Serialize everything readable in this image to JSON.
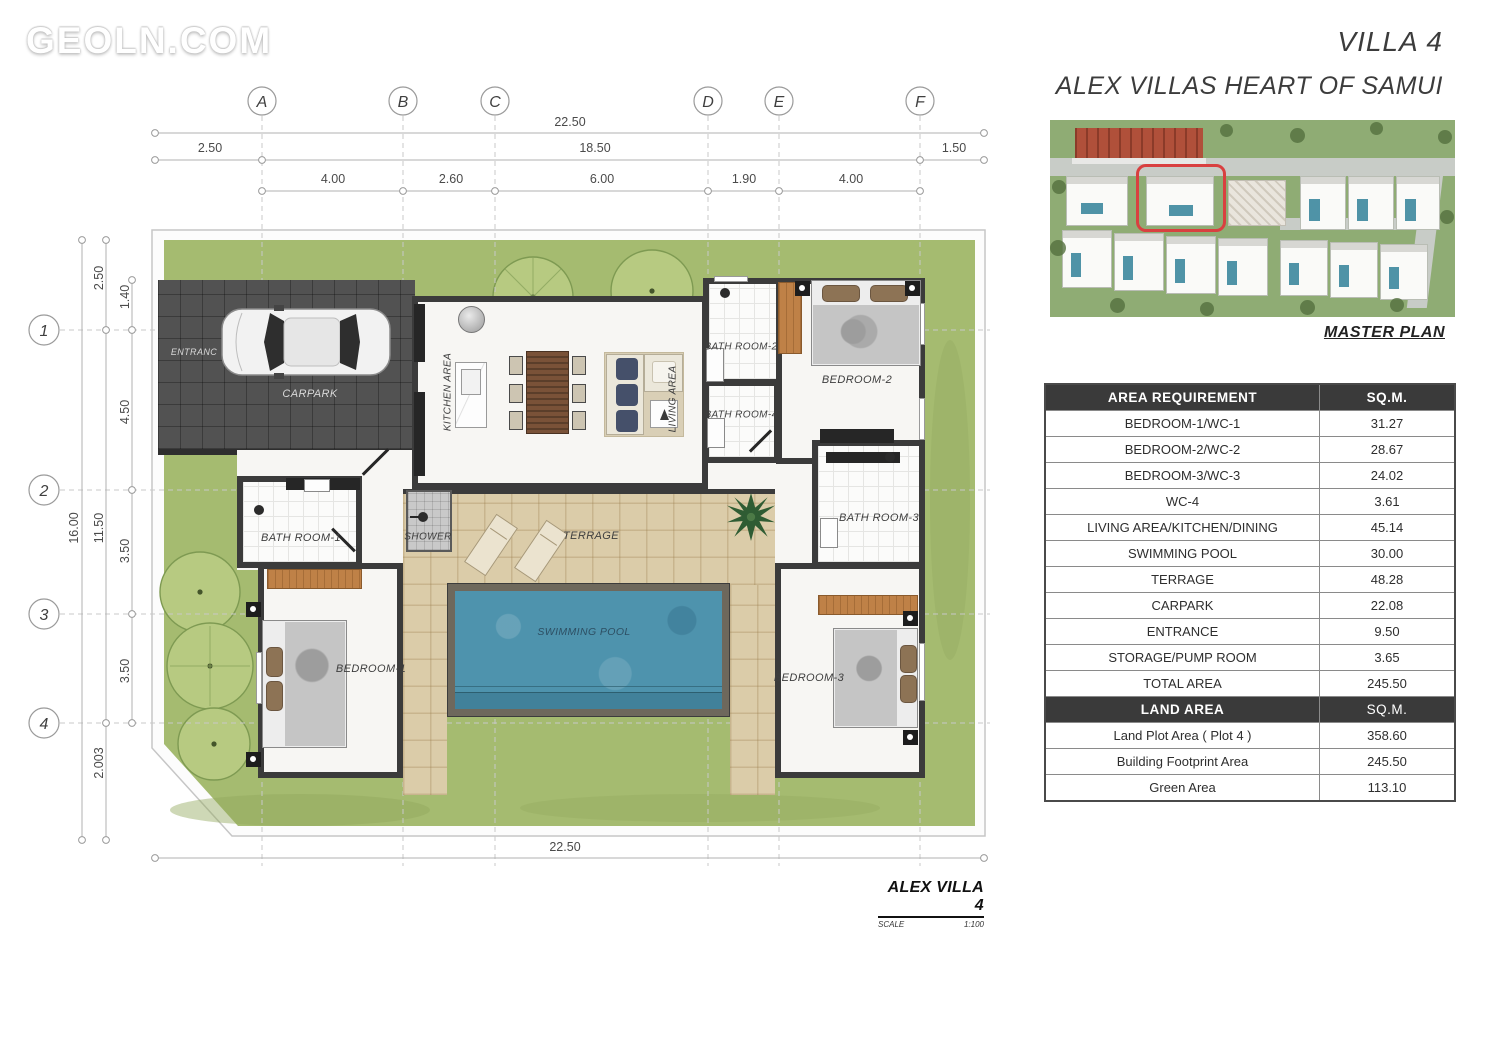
{
  "watermark": "GEOLN.COM",
  "header": {
    "villa": "VILLA 4",
    "project": "ALEX VILLAS HEART OF SAMUI",
    "master_plan": "MASTER PLAN"
  },
  "titleblock": {
    "title": "ALEX VILLA 4",
    "scale_label": "SCALE",
    "scale_value": "1:100"
  },
  "grid": {
    "cols": [
      "A",
      "B",
      "C",
      "D",
      "E",
      "F"
    ],
    "rows": [
      "1",
      "2",
      "3",
      "4"
    ]
  },
  "dims": {
    "top_total": "22.50",
    "top_left": "2.50",
    "top_mid": "18.50",
    "top_right": "1.50",
    "ab": "4.00",
    "bc": "2.60",
    "cd": "6.00",
    "de": "1.90",
    "ef": "4.00",
    "left_total": "16.00",
    "l_top": "2.50",
    "l_mid": "11.50",
    "l_bot": "2.003",
    "i1": "1.40",
    "i2": "4.50",
    "i3": "3.50",
    "i4": "3.50",
    "bottom_total": "22.50"
  },
  "rooms": {
    "entrance": "ENTRANC",
    "carpark": "CARPARK",
    "kitchen": "KITCHEN AREA",
    "living": "LIVING AREA",
    "bath2": "BATH ROOM-2",
    "bath4": "BATH ROOM-4",
    "bedroom2": "BEDROOM-2",
    "bath1": "BATH ROOM-1",
    "shower": "SHOWER",
    "terrage": "TERRAGE",
    "pool": "SWIMMING POOL",
    "bedroom1": "BEDROOM-1",
    "bath3": "BATH ROOM-3",
    "bedroom3": "BEDROOM-3"
  },
  "table": {
    "area_header": {
      "label": "AREA REQUIREMENT",
      "unit": "SQ.M."
    },
    "area_rows": [
      {
        "label": "BEDROOM-1/WC-1",
        "value": "31.27"
      },
      {
        "label": "BEDROOM-2/WC-2",
        "value": "28.67"
      },
      {
        "label": "BEDROOM-3/WC-3",
        "value": "24.02"
      },
      {
        "label": "WC-4",
        "value": "3.61"
      },
      {
        "label": "LIVING AREA/KITCHEN/DINING",
        "value": "45.14"
      },
      {
        "label": "SWIMMING POOL",
        "value": "30.00"
      },
      {
        "label": "TERRAGE",
        "value": "48.28"
      },
      {
        "label": "CARPARK",
        "value": "22.08"
      },
      {
        "label": "ENTRANCE",
        "value": "9.50"
      },
      {
        "label": "STORAGE/PUMP ROOM",
        "value": "3.65"
      },
      {
        "label": "TOTAL AREA",
        "value": "245.50"
      }
    ],
    "land_header": {
      "label": "LAND AREA",
      "unit": "SQ.M."
    },
    "land_rows": [
      {
        "label": "Land Plot Area ( Plot 4 )",
        "value": "358.60"
      },
      {
        "label": "Building Footprint Area",
        "value": "245.50"
      },
      {
        "label": "Green Area",
        "value": "113.10"
      }
    ]
  },
  "colors": {
    "wall": "#3b3b3b",
    "lawn": "#a5bb70",
    "pool_water": "#4e93ad",
    "terrace": "#dbcca9",
    "highlight_red": "#d94040",
    "table_header_bg": "#3a3a3a"
  }
}
